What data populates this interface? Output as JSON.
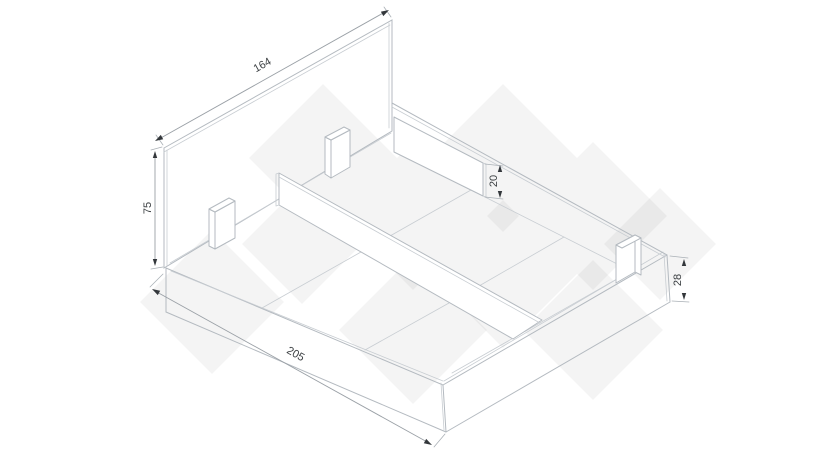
{
  "diagram": {
    "dimensions": {
      "headboard_width": "164",
      "headboard_height": "75",
      "support_rail_height": "20",
      "base_height": "28",
      "frame_length": "205"
    },
    "colors": {
      "background": "#ffffff",
      "drawing_line": "#b4bac0",
      "dimension_line": "#9aa0a6",
      "dimension_text": "#3c4043",
      "arrow": "#33373b",
      "watermark": "#ededee"
    }
  }
}
